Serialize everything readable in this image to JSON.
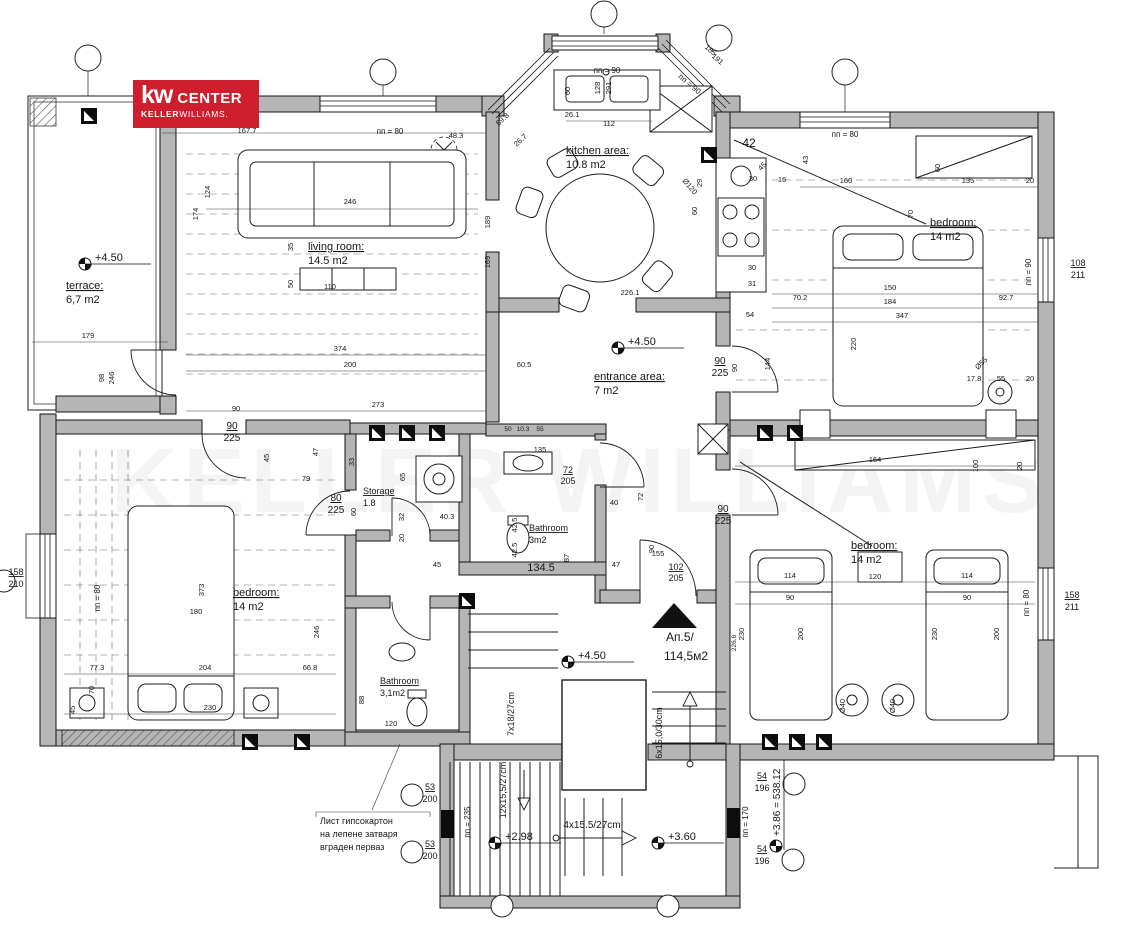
{
  "logo": {
    "kw": "kw",
    "center": "CENTER",
    "keller": "KELLER",
    "williams": "WILLIAMS."
  },
  "watermark": "KELLER WILLIAMS",
  "accent_red": "#e8403e",
  "labels": [
    {
      "t": "terrace:",
      "x": 66,
      "y": 289,
      "s": 11,
      "a": "s",
      "u": 1
    },
    {
      "t": "6,7 m2",
      "x": 66,
      "y": 303,
      "s": 11,
      "a": "s"
    },
    {
      "t": "living room:",
      "x": 308,
      "y": 250,
      "s": 11,
      "a": "s",
      "u": 1
    },
    {
      "t": "14.5 m2",
      "x": 308,
      "y": 264,
      "s": 11,
      "a": "s"
    },
    {
      "t": "kitchen area:",
      "x": 566,
      "y": 154,
      "s": 11,
      "a": "s",
      "u": 1
    },
    {
      "t": "10.8 m2",
      "x": 566,
      "y": 168,
      "s": 11,
      "a": "s"
    },
    {
      "t": "entrance area:",
      "x": 594,
      "y": 380,
      "s": 11,
      "a": "s",
      "u": 1
    },
    {
      "t": "7 m2",
      "x": 594,
      "y": 394,
      "s": 11,
      "a": "s"
    },
    {
      "t": "bedroom:",
      "x": 930,
      "y": 226,
      "s": 11,
      "a": "s",
      "u": 1
    },
    {
      "t": "14 m2",
      "x": 930,
      "y": 240,
      "s": 11,
      "a": "s"
    },
    {
      "t": "bedroom:",
      "x": 233,
      "y": 596,
      "s": 11,
      "a": "s",
      "u": 1
    },
    {
      "t": "14 m2",
      "x": 233,
      "y": 610,
      "s": 11,
      "a": "s"
    },
    {
      "t": "bedroom:",
      "x": 851,
      "y": 549,
      "s": 11,
      "a": "s",
      "u": 1
    },
    {
      "t": "14 m2",
      "x": 851,
      "y": 563,
      "s": 11,
      "a": "s"
    },
    {
      "t": "Storage",
      "x": 363,
      "y": 494,
      "s": 9,
      "a": "s",
      "u": 1
    },
    {
      "t": "1.8",
      "x": 363,
      "y": 506,
      "s": 9,
      "a": "s"
    },
    {
      "t": "Bathroom",
      "x": 529,
      "y": 531,
      "s": 9,
      "a": "s",
      "u": 1
    },
    {
      "t": "3m2",
      "x": 529,
      "y": 543,
      "s": 9,
      "a": "s"
    },
    {
      "t": "Bathroom",
      "x": 380,
      "y": 684,
      "s": 9,
      "a": "s",
      "u": 1
    },
    {
      "t": "3,1m2",
      "x": 380,
      "y": 696,
      "s": 9,
      "a": "s"
    },
    {
      "t": "Ап.5/",
      "x": 666,
      "y": 641,
      "s": 12,
      "a": "s",
      "c": "#e8403e"
    },
    {
      "t": "114,5м2",
      "x": 664,
      "y": 660,
      "s": 12,
      "a": "s",
      "c": "#e8403e"
    },
    {
      "t": "12x15,5/27cm",
      "x": 506,
      "y": 790,
      "s": 9,
      "r": -90
    },
    {
      "t": "7x18/27cm",
      "x": 514,
      "y": 714,
      "s": 9,
      "r": -90
    },
    {
      "t": "4x15.5/27cm",
      "x": 592,
      "y": 828,
      "s": 10
    },
    {
      "t": "6x15,0/30cm",
      "x": 662,
      "y": 733,
      "s": 9,
      "r": -90
    },
    {
      "t": "пп = 235",
      "x": 470,
      "y": 822,
      "s": 8,
      "r": -90
    },
    {
      "t": "пп = 170",
      "x": 748,
      "y": 822,
      "s": 8,
      "r": -90
    },
    {
      "t": "90",
      "x": 232,
      "y": 429,
      "s": 10,
      "u": 1
    },
    {
      "t": "225",
      "x": 232,
      "y": 441,
      "s": 10
    },
    {
      "t": "80",
      "x": 336,
      "y": 501,
      "s": 10,
      "u": 1
    },
    {
      "t": "225",
      "x": 336,
      "y": 513,
      "s": 10
    },
    {
      "t": "90",
      "x": 720,
      "y": 364,
      "s": 10,
      "u": 1
    },
    {
      "t": "225",
      "x": 720,
      "y": 376,
      "s": 10
    },
    {
      "t": "90",
      "x": 723,
      "y": 512,
      "s": 10,
      "u": 1
    },
    {
      "t": "225",
      "x": 723,
      "y": 524,
      "s": 10
    },
    {
      "t": "72",
      "x": 568,
      "y": 473,
      "s": 9,
      "u": 1
    },
    {
      "t": "205",
      "x": 568,
      "y": 484,
      "s": 9
    },
    {
      "t": "102",
      "x": 676,
      "y": 570,
      "s": 9,
      "u": 1
    },
    {
      "t": "205",
      "x": 676,
      "y": 581,
      "s": 9
    },
    {
      "t": "158",
      "x": 16,
      "y": 575,
      "s": 9,
      "u": 1
    },
    {
      "t": "210",
      "x": 16,
      "y": 587,
      "s": 9
    },
    {
      "t": "108",
      "x": 1078,
      "y": 266,
      "s": 9,
      "u": 1
    },
    {
      "t": "211",
      "x": 1078,
      "y": 278,
      "s": 9
    },
    {
      "t": "158",
      "x": 1072,
      "y": 598,
      "s": 9,
      "u": 1
    },
    {
      "t": "211",
      "x": 1072,
      "y": 610,
      "s": 9
    },
    {
      "t": "53",
      "x": 430,
      "y": 790,
      "s": 9,
      "u": 1
    },
    {
      "t": "200",
      "x": 430,
      "y": 802,
      "s": 9
    },
    {
      "t": "53",
      "x": 430,
      "y": 847,
      "s": 9,
      "u": 1
    },
    {
      "t": "200",
      "x": 430,
      "y": 859,
      "s": 9
    },
    {
      "t": "54",
      "x": 762,
      "y": 779,
      "s": 9,
      "u": 1
    },
    {
      "t": "196",
      "x": 762,
      "y": 791,
      "s": 9
    },
    {
      "t": "54",
      "x": 762,
      "y": 852,
      "s": 9,
      "u": 1
    },
    {
      "t": "196",
      "x": 762,
      "y": 864,
      "s": 9
    },
    {
      "t": "пп = 80",
      "x": 390,
      "y": 134,
      "s": 8
    },
    {
      "t": "пп = 80",
      "x": 845,
      "y": 137,
      "s": 8
    },
    {
      "t": "пп = 90",
      "x": 607,
      "y": 73,
      "s": 8
    },
    {
      "t": "пп = 90",
      "x": 688,
      "y": 86,
      "s": 8,
      "r": 40
    },
    {
      "t": "пп = 90",
      "x": 1031,
      "y": 272,
      "s": 8,
      "r": -90
    },
    {
      "t": "пп = 80",
      "x": 100,
      "y": 598,
      "s": 8,
      "r": -90
    },
    {
      "t": "пп = 80",
      "x": 1029,
      "y": 603,
      "s": 8,
      "r": -90
    },
    {
      "t": "167.7",
      "x": 247,
      "y": 133
    },
    {
      "t": "48.3",
      "x": 456,
      "y": 138
    },
    {
      "t": "128",
      "x": 600,
      "y": 88,
      "r": -90
    },
    {
      "t": "291",
      "x": 611,
      "y": 88,
      "r": -90
    },
    {
      "t": "185",
      "x": 709,
      "y": 52,
      "r": 40
    },
    {
      "t": "191",
      "x": 716,
      "y": 61,
      "r": 40
    },
    {
      "t": "69.8",
      "x": 504,
      "y": 121,
      "r": -42
    },
    {
      "t": "26.7",
      "x": 522,
      "y": 142,
      "r": -42
    },
    {
      "t": "26.1",
      "x": 572,
      "y": 117
    },
    {
      "t": "112",
      "x": 609,
      "y": 126
    },
    {
      "t": "60",
      "x": 570,
      "y": 91,
      "r": -90
    },
    {
      "t": "246",
      "x": 350,
      "y": 204
    },
    {
      "t": "174",
      "x": 198,
      "y": 214,
      "r": -90
    },
    {
      "t": "124",
      "x": 210,
      "y": 192,
      "r": -90
    },
    {
      "t": "189",
      "x": 490,
      "y": 222,
      "r": -90
    },
    {
      "t": "169",
      "x": 490,
      "y": 262,
      "r": -90
    },
    {
      "t": "35",
      "x": 293,
      "y": 247,
      "r": -90
    },
    {
      "t": "50",
      "x": 293,
      "y": 284,
      "r": -90
    },
    {
      "t": "110",
      "x": 330,
      "y": 289
    },
    {
      "t": "374",
      "x": 340,
      "y": 351
    },
    {
      "t": "200",
      "x": 350,
      "y": 367
    },
    {
      "t": "60.5",
      "x": 524,
      "y": 367
    },
    {
      "t": "273",
      "x": 378,
      "y": 407
    },
    {
      "t": "90",
      "x": 236,
      "y": 411
    },
    {
      "t": "45",
      "x": 269,
      "y": 458,
      "r": -90
    },
    {
      "t": "47",
      "x": 318,
      "y": 452,
      "r": -90
    },
    {
      "t": "79",
      "x": 306,
      "y": 481
    },
    {
      "t": "Ø120",
      "x": 688,
      "y": 188,
      "r": 50
    },
    {
      "t": "226.1",
      "x": 630,
      "y": 295
    },
    {
      "t": "42",
      "x": 749,
      "y": 147,
      "s": 12
    },
    {
      "t": "45",
      "x": 764,
      "y": 168,
      "r": -45
    },
    {
      "t": "29",
      "x": 702,
      "y": 183,
      "r": -90
    },
    {
      "t": "30",
      "x": 753,
      "y": 181
    },
    {
      "t": "16",
      "x": 782,
      "y": 182
    },
    {
      "t": "60",
      "x": 697,
      "y": 211,
      "r": -90
    },
    {
      "t": "30",
      "x": 752,
      "y": 270
    },
    {
      "t": "31",
      "x": 752,
      "y": 286
    },
    {
      "t": "43",
      "x": 808,
      "y": 160,
      "r": -90
    },
    {
      "t": "160",
      "x": 846,
      "y": 183
    },
    {
      "t": "135",
      "x": 968,
      "y": 183
    },
    {
      "t": "20",
      "x": 1030,
      "y": 183
    },
    {
      "t": "60",
      "x": 940,
      "y": 168,
      "r": -90
    },
    {
      "t": "70",
      "x": 913,
      "y": 214,
      "r": -90
    },
    {
      "t": "70.2",
      "x": 800,
      "y": 300
    },
    {
      "t": "150",
      "x": 890,
      "y": 290
    },
    {
      "t": "184",
      "x": 890,
      "y": 304
    },
    {
      "t": "347",
      "x": 902,
      "y": 318
    },
    {
      "t": "92.7",
      "x": 1006,
      "y": 300
    },
    {
      "t": "220",
      "x": 856,
      "y": 344,
      "r": -90
    },
    {
      "t": "17.8",
      "x": 974,
      "y": 381
    },
    {
      "t": "55",
      "x": 1001,
      "y": 381
    },
    {
      "t": "20",
      "x": 1030,
      "y": 381
    },
    {
      "t": "Ø55",
      "x": 983,
      "y": 365,
      "r": -45
    },
    {
      "t": "54",
      "x": 750,
      "y": 317
    },
    {
      "t": "144",
      "x": 770,
      "y": 364,
      "r": -90
    },
    {
      "t": "90",
      "x": 737,
      "y": 368,
      "r": -90
    },
    {
      "t": "135",
      "x": 540,
      "y": 452
    },
    {
      "t": "50",
      "x": 508,
      "y": 431,
      "s": 6.5
    },
    {
      "t": "10.3",
      "x": 523,
      "y": 431,
      "s": 6.5
    },
    {
      "t": "55",
      "x": 540,
      "y": 431,
      "s": 6.5
    },
    {
      "t": "33",
      "x": 354,
      "y": 462,
      "r": -90
    },
    {
      "t": "65",
      "x": 405,
      "y": 477,
      "r": -90
    },
    {
      "t": "60",
      "x": 356,
      "y": 512,
      "r": -90
    },
    {
      "t": "32",
      "x": 404,
      "y": 517,
      "r": -90
    },
    {
      "t": "20",
      "x": 404,
      "y": 538,
      "r": -90
    },
    {
      "t": "40.3",
      "x": 447,
      "y": 519
    },
    {
      "t": "42.5",
      "x": 517,
      "y": 525,
      "r": -90
    },
    {
      "t": "42.5",
      "x": 517,
      "y": 550,
      "r": -90
    },
    {
      "t": "40",
      "x": 614,
      "y": 505
    },
    {
      "t": "72",
      "x": 643,
      "y": 497,
      "r": -90
    },
    {
      "t": "90",
      "x": 654,
      "y": 549,
      "r": -90
    },
    {
      "t": "87",
      "x": 569,
      "y": 558,
      "r": -90
    },
    {
      "t": "47",
      "x": 616,
      "y": 567
    },
    {
      "t": "155",
      "x": 658,
      "y": 556
    },
    {
      "t": "134.5",
      "x": 541,
      "y": 571,
      "s": 11
    },
    {
      "t": "45",
      "x": 437,
      "y": 567
    },
    {
      "t": "373",
      "x": 204,
      "y": 590,
      "r": -90
    },
    {
      "t": "180",
      "x": 196,
      "y": 614
    },
    {
      "t": "246",
      "x": 319,
      "y": 632,
      "r": -90
    },
    {
      "t": "77.3",
      "x": 97,
      "y": 670
    },
    {
      "t": "204",
      "x": 205,
      "y": 670
    },
    {
      "t": "66.8",
      "x": 310,
      "y": 670
    },
    {
      "t": "70",
      "x": 94,
      "y": 690,
      "r": -90
    },
    {
      "t": "45",
      "x": 75,
      "y": 710,
      "r": -90
    },
    {
      "t": "230",
      "x": 210,
      "y": 710
    },
    {
      "t": "88",
      "x": 364,
      "y": 700,
      "r": -90
    },
    {
      "t": "120",
      "x": 391,
      "y": 726
    },
    {
      "t": "164",
      "x": 875,
      "y": 462
    },
    {
      "t": "114",
      "x": 790,
      "y": 578
    },
    {
      "t": "120",
      "x": 875,
      "y": 579
    },
    {
      "t": "114",
      "x": 967,
      "y": 578
    },
    {
      "t": "90",
      "x": 790,
      "y": 600
    },
    {
      "t": "90",
      "x": 967,
      "y": 600
    },
    {
      "t": "230",
      "x": 744,
      "y": 634,
      "r": -90
    },
    {
      "t": "200",
      "x": 803,
      "y": 634,
      "r": -90
    },
    {
      "t": "226.6",
      "x": 736,
      "y": 643,
      "r": -90,
      "s": 6.5
    },
    {
      "t": "230",
      "x": 937,
      "y": 634,
      "r": -90
    },
    {
      "t": "200",
      "x": 999,
      "y": 634,
      "r": -90
    },
    {
      "t": "Ø40",
      "x": 845,
      "y": 706,
      "r": -90
    },
    {
      "t": "Ø40",
      "x": 895,
      "y": 706,
      "r": -90
    },
    {
      "t": "100",
      "x": 978,
      "y": 466,
      "r": -90
    },
    {
      "t": "20",
      "x": 1022,
      "y": 466,
      "r": -90
    },
    {
      "t": "179",
      "x": 88,
      "y": 338
    },
    {
      "t": "98",
      "x": 104,
      "y": 378,
      "r": -90
    },
    {
      "t": "246",
      "x": 114,
      "y": 378,
      "r": -90
    },
    {
      "t": "Лист гипсокартон",
      "x": 320,
      "y": 824,
      "s": 9,
      "a": "s"
    },
    {
      "t": "на лепене затваря",
      "x": 320,
      "y": 837,
      "s": 9,
      "a": "s"
    },
    {
      "t": "вграден перваз",
      "x": 320,
      "y": 850,
      "s": 9,
      "a": "s"
    }
  ],
  "elevations": [
    {
      "t": "+4.50",
      "x": 85,
      "y": 264
    },
    {
      "t": "+4.50",
      "x": 618,
      "y": 348
    },
    {
      "t": "+4.50",
      "x": 568,
      "y": 662
    },
    {
      "t": "+2.98",
      "x": 495,
      "y": 843
    },
    {
      "t": "+3.60",
      "x": 658,
      "y": 843
    },
    {
      "t": "+3.86 = 538.12",
      "x": 776,
      "y": 846,
      "vert": 1
    }
  ],
  "grid_bubbles": [
    {
      "x": 88,
      "y": 58,
      "sx": 88,
      "sy": 96
    },
    {
      "x": 383,
      "y": 72,
      "sx": 383,
      "sy": 96
    },
    {
      "x": 604,
      "y": 14,
      "sx": 604,
      "sy": 34
    },
    {
      "x": 719,
      "y": 38,
      "sx": 712,
      "sy": 52
    },
    {
      "x": 845,
      "y": 72,
      "sx": 845,
      "sy": 112
    },
    {
      "x": 412,
      "y": 795,
      "r": 11
    },
    {
      "x": 412,
      "y": 852,
      "r": 11
    },
    {
      "x": 794,
      "y": 784,
      "r": 11
    },
    {
      "x": 793,
      "y": 860,
      "r": 11
    },
    {
      "x": 502,
      "y": 906,
      "r": 11
    },
    {
      "x": 668,
      "y": 906,
      "r": 11
    },
    {
      "x": 4,
      "y": 581,
      "r": 11
    }
  ],
  "columns": [
    {
      "x": 377,
      "y": 433
    },
    {
      "x": 407,
      "y": 433
    },
    {
      "x": 437,
      "y": 433
    },
    {
      "x": 765,
      "y": 433
    },
    {
      "x": 795,
      "y": 433
    },
    {
      "x": 250,
      "y": 742
    },
    {
      "x": 302,
      "y": 742
    },
    {
      "x": 770,
      "y": 742
    },
    {
      "x": 797,
      "y": 742
    },
    {
      "x": 824,
      "y": 742
    },
    {
      "x": 709,
      "y": 155
    },
    {
      "x": 89,
      "y": 116
    },
    {
      "x": 467,
      "y": 601
    }
  ]
}
